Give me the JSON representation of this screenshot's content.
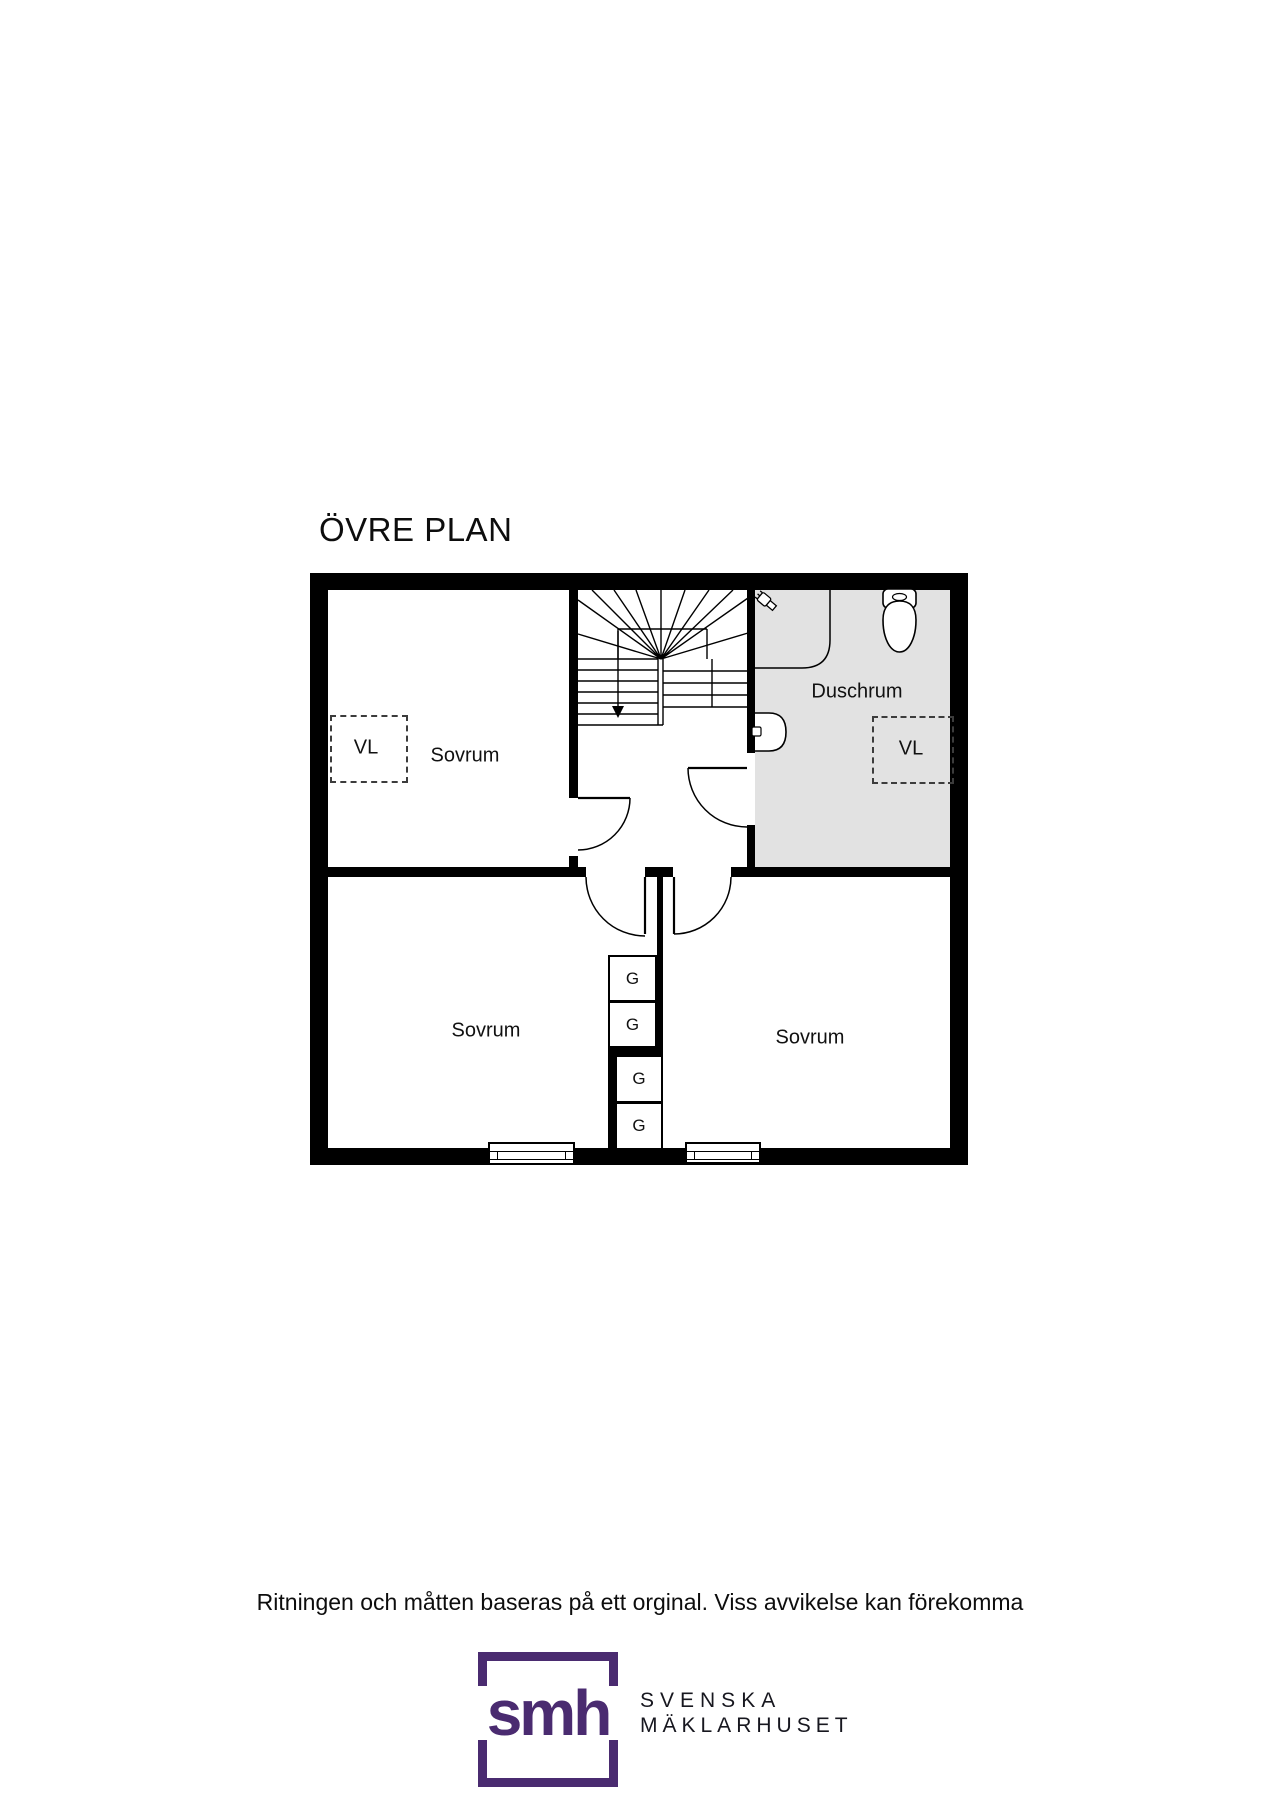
{
  "page": {
    "title": "ÖVRE PLAN",
    "disclaimer": "Ritningen och måtten baseras på ett orginal. Viss avvikelse kan förekomma",
    "background_color": "#ffffff"
  },
  "floorplan": {
    "wall_color": "#000000",
    "line_color": "#000000",
    "rooms": [
      {
        "id": "sovrum-top-left",
        "label": "Sovrum",
        "floor_color": "#ffffff"
      },
      {
        "id": "duschrum",
        "label": "Duschrum",
        "floor_color": "#e2e2e2"
      },
      {
        "id": "sovrum-bottom-left",
        "label": "Sovrum",
        "floor_color": "#ffffff"
      },
      {
        "id": "sovrum-bottom-right",
        "label": "Sovrum",
        "floor_color": "#ffffff"
      }
    ],
    "wardrobes": [
      {
        "label": "G"
      },
      {
        "label": "G"
      },
      {
        "label": "G"
      },
      {
        "label": "G"
      }
    ],
    "vl_markers": [
      {
        "label": "VL",
        "location": "sovrum-top-left"
      },
      {
        "label": "VL",
        "location": "duschrum"
      }
    ],
    "stairs": {
      "type": "winder-staircase",
      "direction": "down-arrow"
    },
    "fixtures": [
      "shower-head",
      "shower-partition",
      "toilet",
      "sink"
    ],
    "window_count": 2,
    "door_count": 4
  },
  "branding": {
    "logo_monogram": "smh",
    "name_line1": "SVENSKA",
    "name_line2": "MÄKLARHUSET",
    "brand_color": "#4A2B70"
  }
}
